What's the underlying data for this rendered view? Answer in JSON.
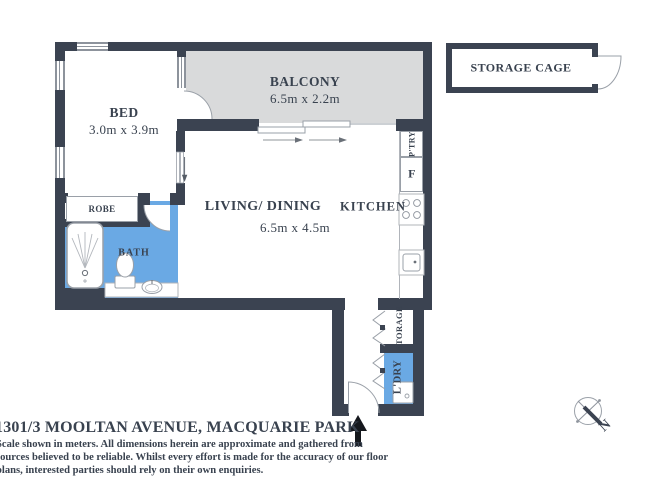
{
  "address": "1301/3 MOOLTAN AVENUE, MACQUARIE PARK",
  "disclaimer_lines": [
    "Scale shown in meters. All dimensions herein are approximate and gathered from",
    "sources believed to be reliable. Whilst every effort is made for the accuracy of our floor",
    "plans, interested parties should rely on their own enquiries."
  ],
  "rooms": {
    "bed": {
      "name": "BED",
      "dims": "3.0m x 3.9m"
    },
    "balcony": {
      "name": "BALCONY",
      "dims": "6.5m x 2.2m"
    },
    "living_dining": {
      "name": "LIVING/ DINING",
      "dims": "6.5m x 4.5m"
    },
    "kitchen": {
      "name": "KITCHEN"
    },
    "bath": {
      "name": "BATH"
    },
    "robe": {
      "name": "ROBE"
    },
    "pantry": {
      "name": "P'TRY"
    },
    "fridge": {
      "name": "F"
    },
    "storage": {
      "name": "STORAGE"
    },
    "laundry": {
      "name": "L'DRY"
    },
    "storage_cage": {
      "name": "STORAGE CAGE"
    }
  },
  "compass": {
    "north": "N"
  },
  "colors": {
    "wall": "#3b4351",
    "wet_area_fill": "#6aa9e4",
    "balcony_fill": "#d9dadb",
    "text": "#39424f",
    "entry_arrow": "#15181d"
  }
}
